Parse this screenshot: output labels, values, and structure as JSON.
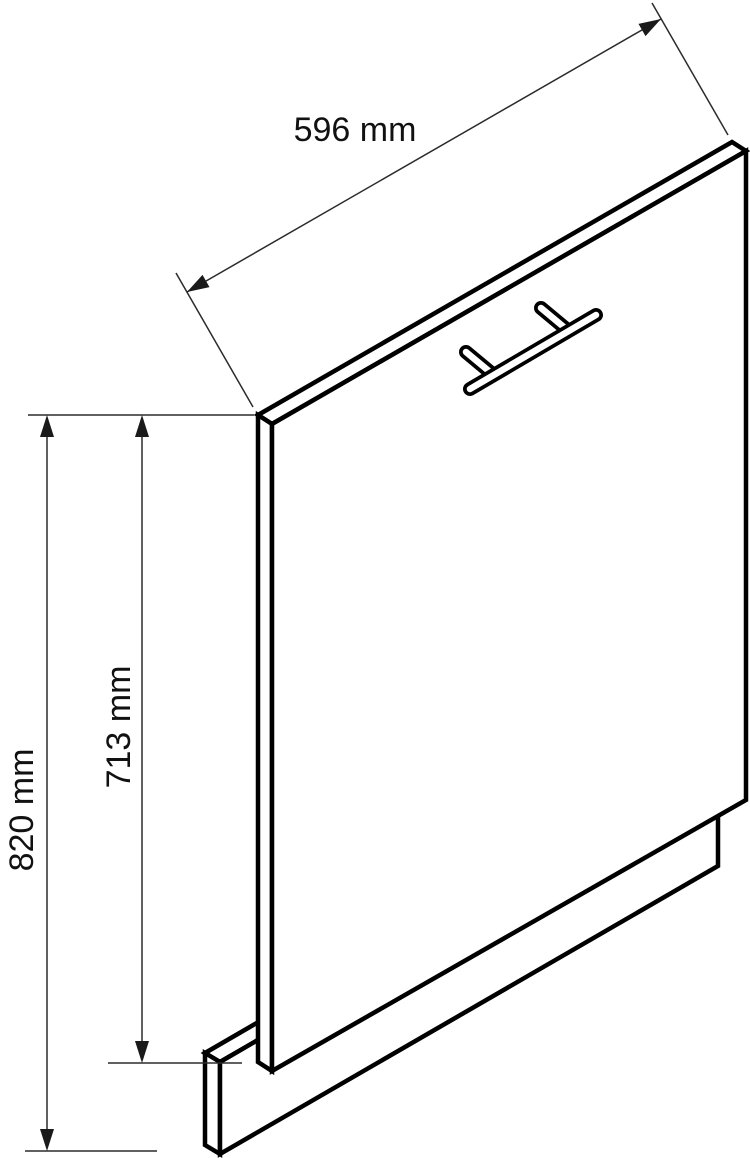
{
  "drawing": {
    "background": "#ffffff",
    "object_line_color": "#000000",
    "dimension_line_color": "#2b2b2b",
    "parts": [
      "front-panel",
      "bar-handle",
      "plinth-strip"
    ],
    "dimensions": {
      "width": {
        "value": 596,
        "unit": "mm",
        "label": "596 mm"
      },
      "panel_height": {
        "value": 713,
        "unit": "mm",
        "label": "713 mm"
      },
      "total_height": {
        "value": 820,
        "unit": "mm",
        "label": "820 mm"
      }
    }
  }
}
